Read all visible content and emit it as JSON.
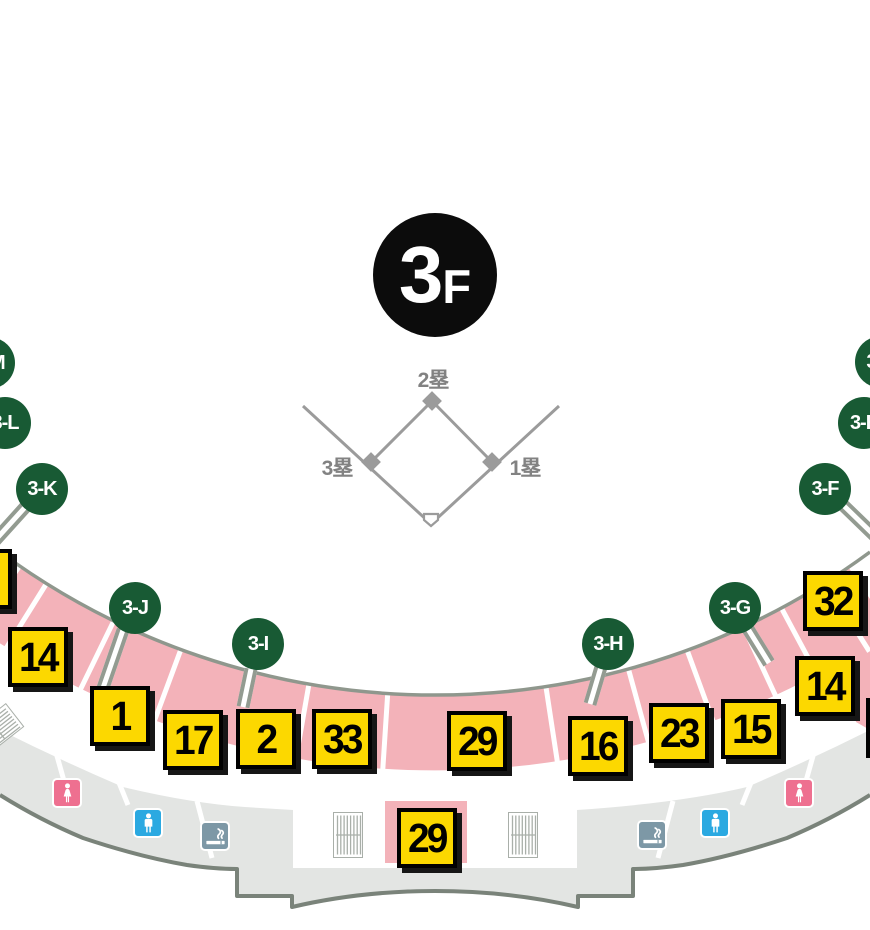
{
  "floor_badge": {
    "number": "3",
    "suffix": "F"
  },
  "field": {
    "second_base": "2塁",
    "third_base": "3塁",
    "first_base": "1塁"
  },
  "gates": [
    {
      "label": "3-M",
      "cx": -11,
      "cy": 363
    },
    {
      "label": "3-L",
      "cx": 5,
      "cy": 423
    },
    {
      "label": "3-K",
      "cx": 42,
      "cy": 489
    },
    {
      "label": "3-J",
      "cx": 135,
      "cy": 608
    },
    {
      "label": "3-I",
      "cx": 258,
      "cy": 644
    },
    {
      "label": "3-H",
      "cx": 608,
      "cy": 644
    },
    {
      "label": "3-G",
      "cx": 735,
      "cy": 608
    },
    {
      "label": "3-F",
      "cx": 825,
      "cy": 489
    },
    {
      "label": "3-E",
      "cx": 864,
      "cy": 423
    },
    {
      "label": "3-D",
      "cx": 881,
      "cy": 362
    }
  ],
  "sections": [
    {
      "label": "",
      "x": -48,
      "y": 549
    },
    {
      "label": "14",
      "x": 8,
      "y": 627
    },
    {
      "label": "1",
      "x": 90,
      "y": 686
    },
    {
      "label": "17",
      "x": 163,
      "y": 710
    },
    {
      "label": "2",
      "x": 236,
      "y": 709
    },
    {
      "label": "33",
      "x": 312,
      "y": 709
    },
    {
      "label": "29",
      "x": 447,
      "y": 711
    },
    {
      "label": "16",
      "x": 568,
      "y": 716
    },
    {
      "label": "23",
      "x": 649,
      "y": 703
    },
    {
      "label": "15",
      "x": 721,
      "y": 699
    },
    {
      "label": "14",
      "x": 795,
      "y": 656
    },
    {
      "label": "32",
      "x": 803,
      "y": 571
    },
    {
      "label": "",
      "x": 866,
      "y": 698
    },
    {
      "label": "29",
      "x": 397,
      "y": 808
    }
  ],
  "facilities": [
    {
      "type": "restroom-female",
      "x": 52,
      "y": 778
    },
    {
      "type": "restroom-male",
      "x": 133,
      "y": 808
    },
    {
      "type": "smoking-area",
      "x": 200,
      "y": 821
    },
    {
      "type": "smoking-area",
      "x": 637,
      "y": 820
    },
    {
      "type": "restroom-male",
      "x": 700,
      "y": 808
    },
    {
      "type": "restroom-female",
      "x": 784,
      "y": 778
    },
    {
      "type": "stairs",
      "x": 333,
      "y": 812,
      "rot": 0
    },
    {
      "type": "stairs",
      "x": 508,
      "y": 812,
      "rot": 0
    },
    {
      "type": "stairs",
      "x": -18,
      "y": 706,
      "rot": 52
    }
  ],
  "colors": {
    "section_fill": "#FCD800",
    "seating_band": "#F3B2B9",
    "gate_green": "#185A34",
    "concourse": "#E3E5E3",
    "outline": "#7A837A",
    "boundary_line": "#8F978D",
    "female": "#EE7090",
    "male": "#2BA9E1",
    "smoking": "#7D98A6",
    "floor_badge_bg": "#0C0C0C"
  }
}
